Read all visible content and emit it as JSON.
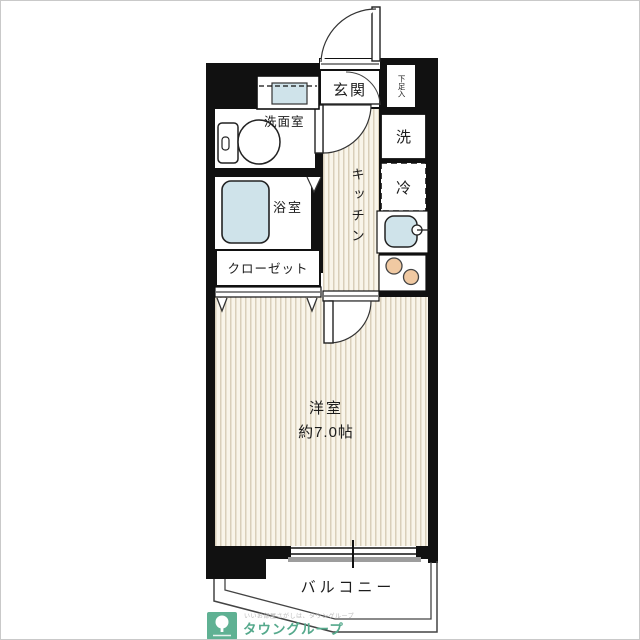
{
  "floorplan": {
    "labels": {
      "genkan": "玄関",
      "shoe_box": "下足入",
      "washroom": "洗面室",
      "bathroom": "浴室",
      "kitchen": "キッチン",
      "washer": "洗",
      "fridge": "冷",
      "closet": "クローゼット",
      "main_room": "洋室",
      "main_room_size": "約7.0帖",
      "balcony": "バルコニー"
    },
    "colors": {
      "wall": "#111111",
      "floor_stripe_bg": "#f9f5ea",
      "floor_stripe_line": "#d9cfba",
      "fixture_blue": "#cfe3ea",
      "burner_orange": "#f0c9a2",
      "window_sill_gray": "#9d9d9d"
    }
  },
  "branding": {
    "company": "タウングループ",
    "tagline": "いいお部屋さがしは、タウングループ",
    "logo_color": "#5fb193"
  }
}
